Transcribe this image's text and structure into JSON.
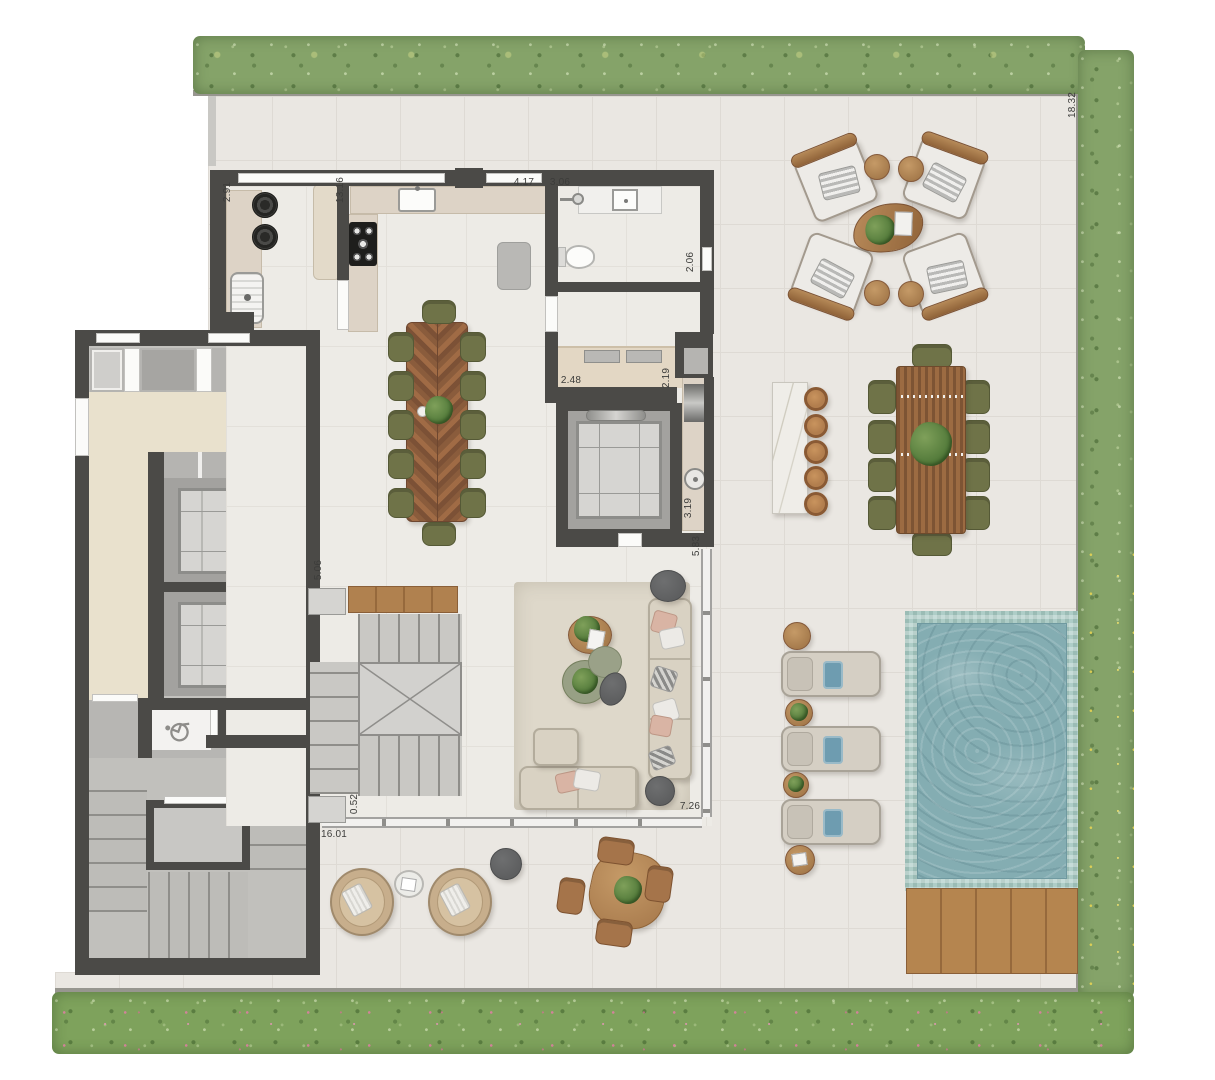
{
  "title": "Penthouse floor plan with terrace and pool",
  "palette": {
    "wall": "#4b4a47",
    "floor": "#eae7e2",
    "floor_line": "#dedad4",
    "interior_floor": "#edebe6",
    "hall_floor": "#e9e1cd",
    "concrete": "#c3c2be",
    "closet_gray": "#b5b4b1",
    "hedge_green": "#85a369",
    "garden_green": "#7ea25c",
    "flower_pink": "#dd7fa4",
    "flower_yellow": "#e0cc55",
    "pool_water": "#84adb2",
    "pool_trim": "#aecdc7",
    "deck_wood": "#b5854f",
    "table_wood": "#96684a",
    "slat_wood": "#9c6b42",
    "olive_chair": "#6f7348",
    "marble": "#efede8",
    "stool_wood": "#b27e4e",
    "sofa_beige": "#d9d2c3",
    "rug_beige": "#ded8ca",
    "counter_beige": "#ddd3c6",
    "cushion_white": "#edebe7",
    "towel_blue": "#6e9cb0",
    "pouf_gray": "#5e5f60",
    "elevator_gray": "#a3a29f",
    "cab_gray": "#d6d5d2",
    "parapet_gray": "#97968f",
    "glass_line": "#a3a2a0",
    "label_text": "#3c3c3a"
  },
  "dims": {
    "laundry_width": "2.91",
    "kitchen_length": "13.16",
    "kitchen_width": "4.17",
    "bath_length": "3.06",
    "bath_width": "2.06",
    "pantry_width": "2.48",
    "pantry_depth": "2.19",
    "counter_length": "3.19",
    "lobby_depth": "5.83",
    "hall_width": "5.06",
    "stair_offset": "0.52",
    "living_width": "7.26",
    "terrace_width": "16.01",
    "terrace_depth": "18.32"
  },
  "icons": {
    "wheelchair": "wheelchair-icon",
    "shower": "shower-icon",
    "toilet": "toilet-icon",
    "sink": "sink-icon",
    "stove": "stove-icon",
    "washer": "washer-icon",
    "plant": "plant-icon",
    "elevator": "elevator-icon"
  }
}
